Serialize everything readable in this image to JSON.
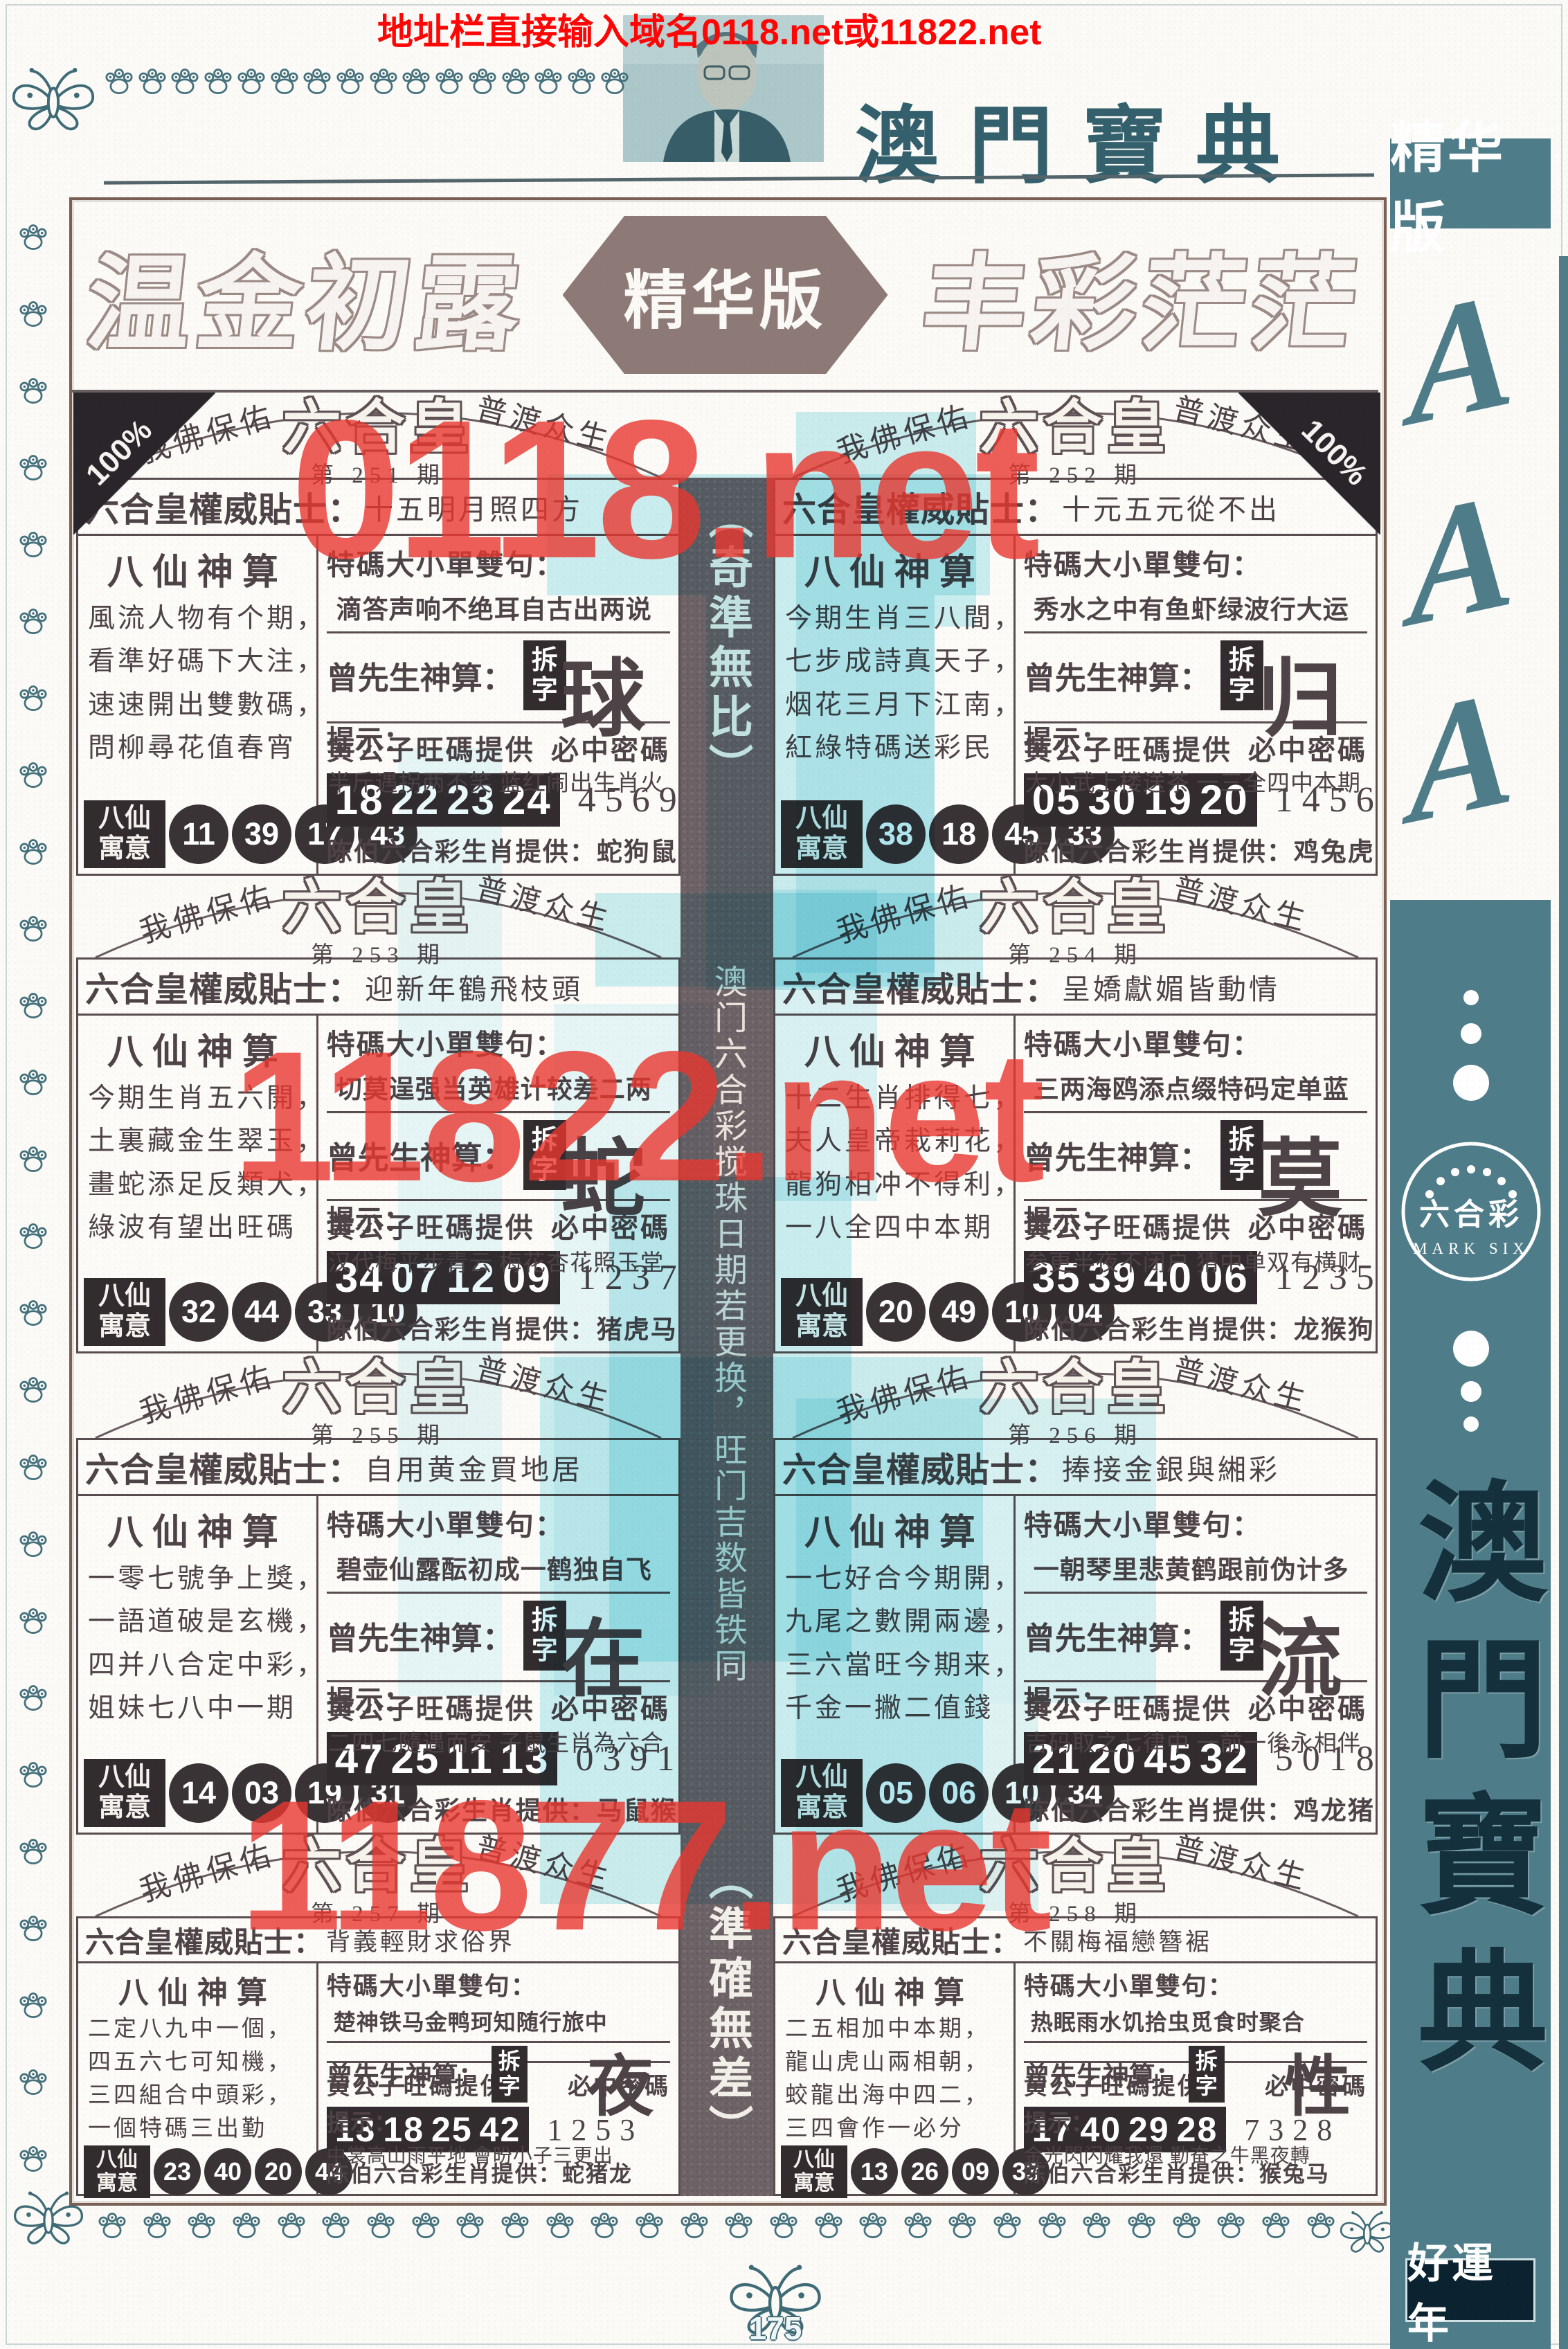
{
  "header": {
    "top_banner": "地址栏直接输入域名0118.net或11822.net",
    "page_title": "澳門寶典",
    "banner_left": "温金初露",
    "banner_center": "精华版",
    "banner_right": "丰彩茫茫"
  },
  "watermarks": {
    "top": "0118.net",
    "middle": "11822.net",
    "bottom": "11877.net"
  },
  "center_strip": {
    "top_bracket": "（奇準無比）",
    "body": "澳门六合彩搅珠日期若更换，旺门吉数皆铁同",
    "bottom_bracket": "（準確無差）"
  },
  "sidebar": {
    "top_badge": "精华版",
    "a_letters": [
      "A",
      "A",
      "A"
    ],
    "logo_cn": "六合彩",
    "logo_en": "MARK SIX",
    "vertical_title": "澳門寶典",
    "bottom_badge": "好運年"
  },
  "labels": {
    "blessing_left": "我佛保佑",
    "blessing_right": "普渡众生",
    "panel_logo": "六合皇",
    "issue_prefix": "第",
    "issue_suffix": "期",
    "badge_100": "100%",
    "tip_label": "六合皇權威貼士：",
    "immortals_title": "八仙神算",
    "special_label": "特碼大小單雙句：",
    "zeng_label": "曾先生神算：",
    "chaizi_badge": "拆字",
    "hint_label": "提示：",
    "wang_label": "黄公子旺碼提供",
    "code_label": "必中密碼",
    "yuyi_label": "八仙寓意",
    "zodiac_label": "陈伯六合彩生肖提供："
  },
  "panels": [
    {
      "issue": "251",
      "badge": "left",
      "tip": "十五明月照四方",
      "poem": [
        "風流人物有个期，",
        "看準好碼下大注，",
        "速速開出雙數碼，",
        "問柳尋花值春宵"
      ],
      "special": "滴答声响不绝耳自古出两说",
      "chaizi": "球",
      "hint": "半斤遇拐两不笑 蓝红闹出生肖火",
      "lucky": [
        "18",
        "22",
        "23",
        "24"
      ],
      "code": "4569",
      "yuyi": [
        "11",
        "39",
        "17",
        "43"
      ],
      "zodiac": "蛇狗鼠"
    },
    {
      "issue": "252",
      "badge": "right",
      "tip": "十元五元從不出",
      "poem": [
        "今期生肖三八間，",
        "七步成詩真天子，",
        "烟花三月下江南，",
        "紅綠特碼送彩民"
      ],
      "special": "秀水之中有鱼虾绿波行大运",
      "chaizi": "归",
      "hint": "大小武上楼送茶 一三全四中本期",
      "lucky": [
        "05",
        "30",
        "19",
        "20"
      ],
      "code": "1456",
      "yuyi": [
        "38",
        "18",
        "45",
        "33"
      ],
      "zodiac": "鸡兔虎"
    },
    {
      "issue": "253",
      "tip": "迎新年鶴飛枝頭",
      "poem": [
        "今期生肖五六開，",
        "土裏藏金生翠玉，",
        "畫蛇添足反類犬，",
        "綠波有望出旺碼"
      ],
      "special": "切莫逞强当英雄计较差二两",
      "chaizi": "蛇",
      "hint": "汉代梅平步青云 梅花杏花照玉堂",
      "lucky": [
        "34",
        "07",
        "12",
        "09"
      ],
      "code": "1237",
      "yuyi": [
        "32",
        "44",
        "33",
        "10"
      ],
      "zodiac": "猪虎马"
    },
    {
      "issue": "254",
      "tip": "呈嬌獻媚皆動情",
      "poem": [
        "十二生肖排得七，",
        "夫人皇帝栽莉花，",
        "龍狗相冲不得利，",
        "一八全四中本期"
      ],
      "special": "三两海鸥添点缀特码定单蓝",
      "chaizi": "莫",
      "hint": "参更半夜不闭户 猜中单双有横财",
      "lucky": [
        "35",
        "39",
        "40",
        "06"
      ],
      "code": "1235",
      "yuyi": [
        "20",
        "49",
        "10",
        "04"
      ],
      "zodiac": "龙猴狗"
    },
    {
      "issue": "255",
      "tip": "自用黄金買地居",
      "poem": [
        "一零七號争上獎，",
        "一語道破是玄機，",
        "四并八合定中彩，",
        "姐妹七八中一期"
      ],
      "special": "碧壶仙露酝初成一鹤独自飞",
      "chaizi": "在",
      "hint": "二四七隨遇而安 子鼠生肖為六合",
      "lucky": [
        "47",
        "25",
        "11",
        "13"
      ],
      "code": "0391",
      "yuyi": [
        "14",
        "03",
        "19",
        "31"
      ],
      "zodiac": "马鼠猴"
    },
    {
      "issue": "256",
      "tip": "捧接金銀與緗彩",
      "poem": [
        "一七好合今期開，",
        "九尾之數開兩邊，",
        "三六當旺今期来，",
        "千金一撇二值錢"
      ],
      "special": "一朝琴里悲黄鹤跟前伪计多",
      "chaizi": "流",
      "hint": "吉码取之七律中 一前一後永相伴",
      "lucky": [
        "21",
        "20",
        "45",
        "32"
      ],
      "code": "5018",
      "yuyi": [
        "05",
        "06",
        "10",
        "34"
      ],
      "zodiac": "鸡龙猪"
    },
    {
      "issue": "257",
      "tip": "背義輕財求俗界",
      "poem": [
        "二定八九中一個，",
        "四五六七可知機，",
        "三四組合中頭彩，",
        "一個特碼三出勤"
      ],
      "special": "楚神铁马金鸭珂知随行旅中",
      "chaizi": "夜",
      "hint": "中裳高山雨平地 會昐小子三更出",
      "lucky": [
        "13",
        "18",
        "25",
        "42"
      ],
      "code": "1253",
      "yuyi": [
        "23",
        "40",
        "20",
        "44"
      ],
      "zodiac": "蛇猪龙"
    },
    {
      "issue": "258",
      "tip": "不關梅福戀簪裾",
      "poem": [
        "二五相加中本期，",
        "龍山虎山兩相朝，",
        "蛟龍出海中四二，",
        "三四會作一必分"
      ],
      "special": "热眠雨水饥拾虫觅食时聚合",
      "chaizi": "性",
      "hint": "金光閃闪耀我還 勤奋之牛黑夜轉",
      "lucky": [
        "17",
        "40",
        "29",
        "28"
      ],
      "code": "7328",
      "yuyi": [
        "13",
        "26",
        "09",
        "33"
      ],
      "zodiac": "猴兔马"
    }
  ],
  "footer": {
    "page_number": "175"
  }
}
